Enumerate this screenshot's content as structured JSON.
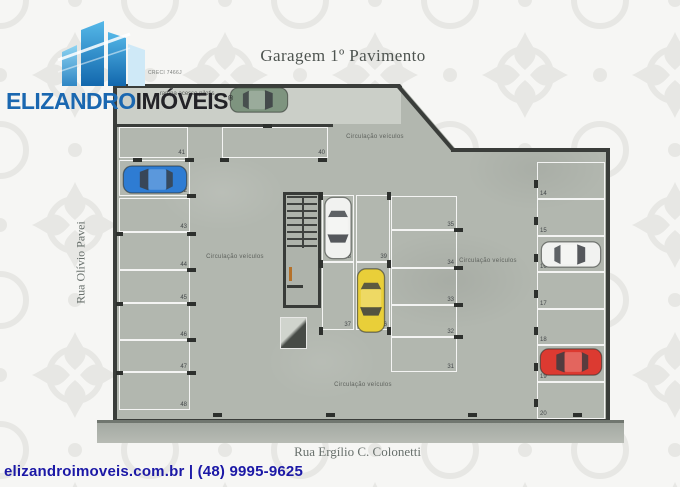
{
  "logo": {
    "brand_blue": "ELIZANDRO",
    "brand_dark": "IMÓVEIS",
    "registered_mark": "®"
  },
  "header": {
    "title": "Garagem 1º Pavimento"
  },
  "plan": {
    "creci_text": "CRECI 7466J",
    "ramp_label": "rampa acesso pilotis →",
    "circulation_label": "Circulação veículos",
    "spots": [
      {
        "label": "41"
      },
      {
        "label": "40"
      },
      {
        "label": "42",
        "car": "blue"
      },
      {
        "label": "43"
      },
      {
        "label": "44"
      },
      {
        "label": "45"
      },
      {
        "label": "46"
      },
      {
        "label": "47"
      },
      {
        "label": "48"
      },
      {
        "label": "38",
        "car": "white"
      },
      {
        "label": "39"
      },
      {
        "label": "37"
      },
      {
        "label": "36",
        "car": "yellow"
      },
      {
        "label": "35"
      },
      {
        "label": "34"
      },
      {
        "label": "33"
      },
      {
        "label": "32"
      },
      {
        "label": "31"
      },
      {
        "label": "14"
      },
      {
        "label": "15"
      },
      {
        "label": "16",
        "car": "white-2"
      },
      {
        "label": "17"
      },
      {
        "label": "18"
      },
      {
        "label": "19",
        "car": "red"
      },
      {
        "label": "20"
      }
    ],
    "cars": [
      {
        "name": "green",
        "color": "#7e947f",
        "location": "ramp"
      },
      {
        "name": "blue",
        "color": "#2e7cd3",
        "location": "spot 42"
      },
      {
        "name": "white",
        "color": "#f1f2f0",
        "location": "spot 38"
      },
      {
        "name": "yellow",
        "color": "#e9cf39",
        "location": "spot 36"
      },
      {
        "name": "white-2",
        "color": "#f1f2f0",
        "location": "spot 16"
      },
      {
        "name": "red",
        "color": "#dc3a31",
        "location": "spot 19"
      }
    ]
  },
  "streets": {
    "left": "Rua Olívio Pavei",
    "bottom": "Rua Ergílio C. Colonetti"
  },
  "footer": {
    "contact": "elizandroimoveis.com.br | (48) 9995-9625"
  },
  "colors": {
    "brand_blue": "#1a67b0",
    "brand_dark": "#232327",
    "contact_navy": "#1b18a6",
    "concrete": "#b2b7af",
    "concrete_light": "#cbcfc8",
    "wall": "#3a3d3a"
  }
}
